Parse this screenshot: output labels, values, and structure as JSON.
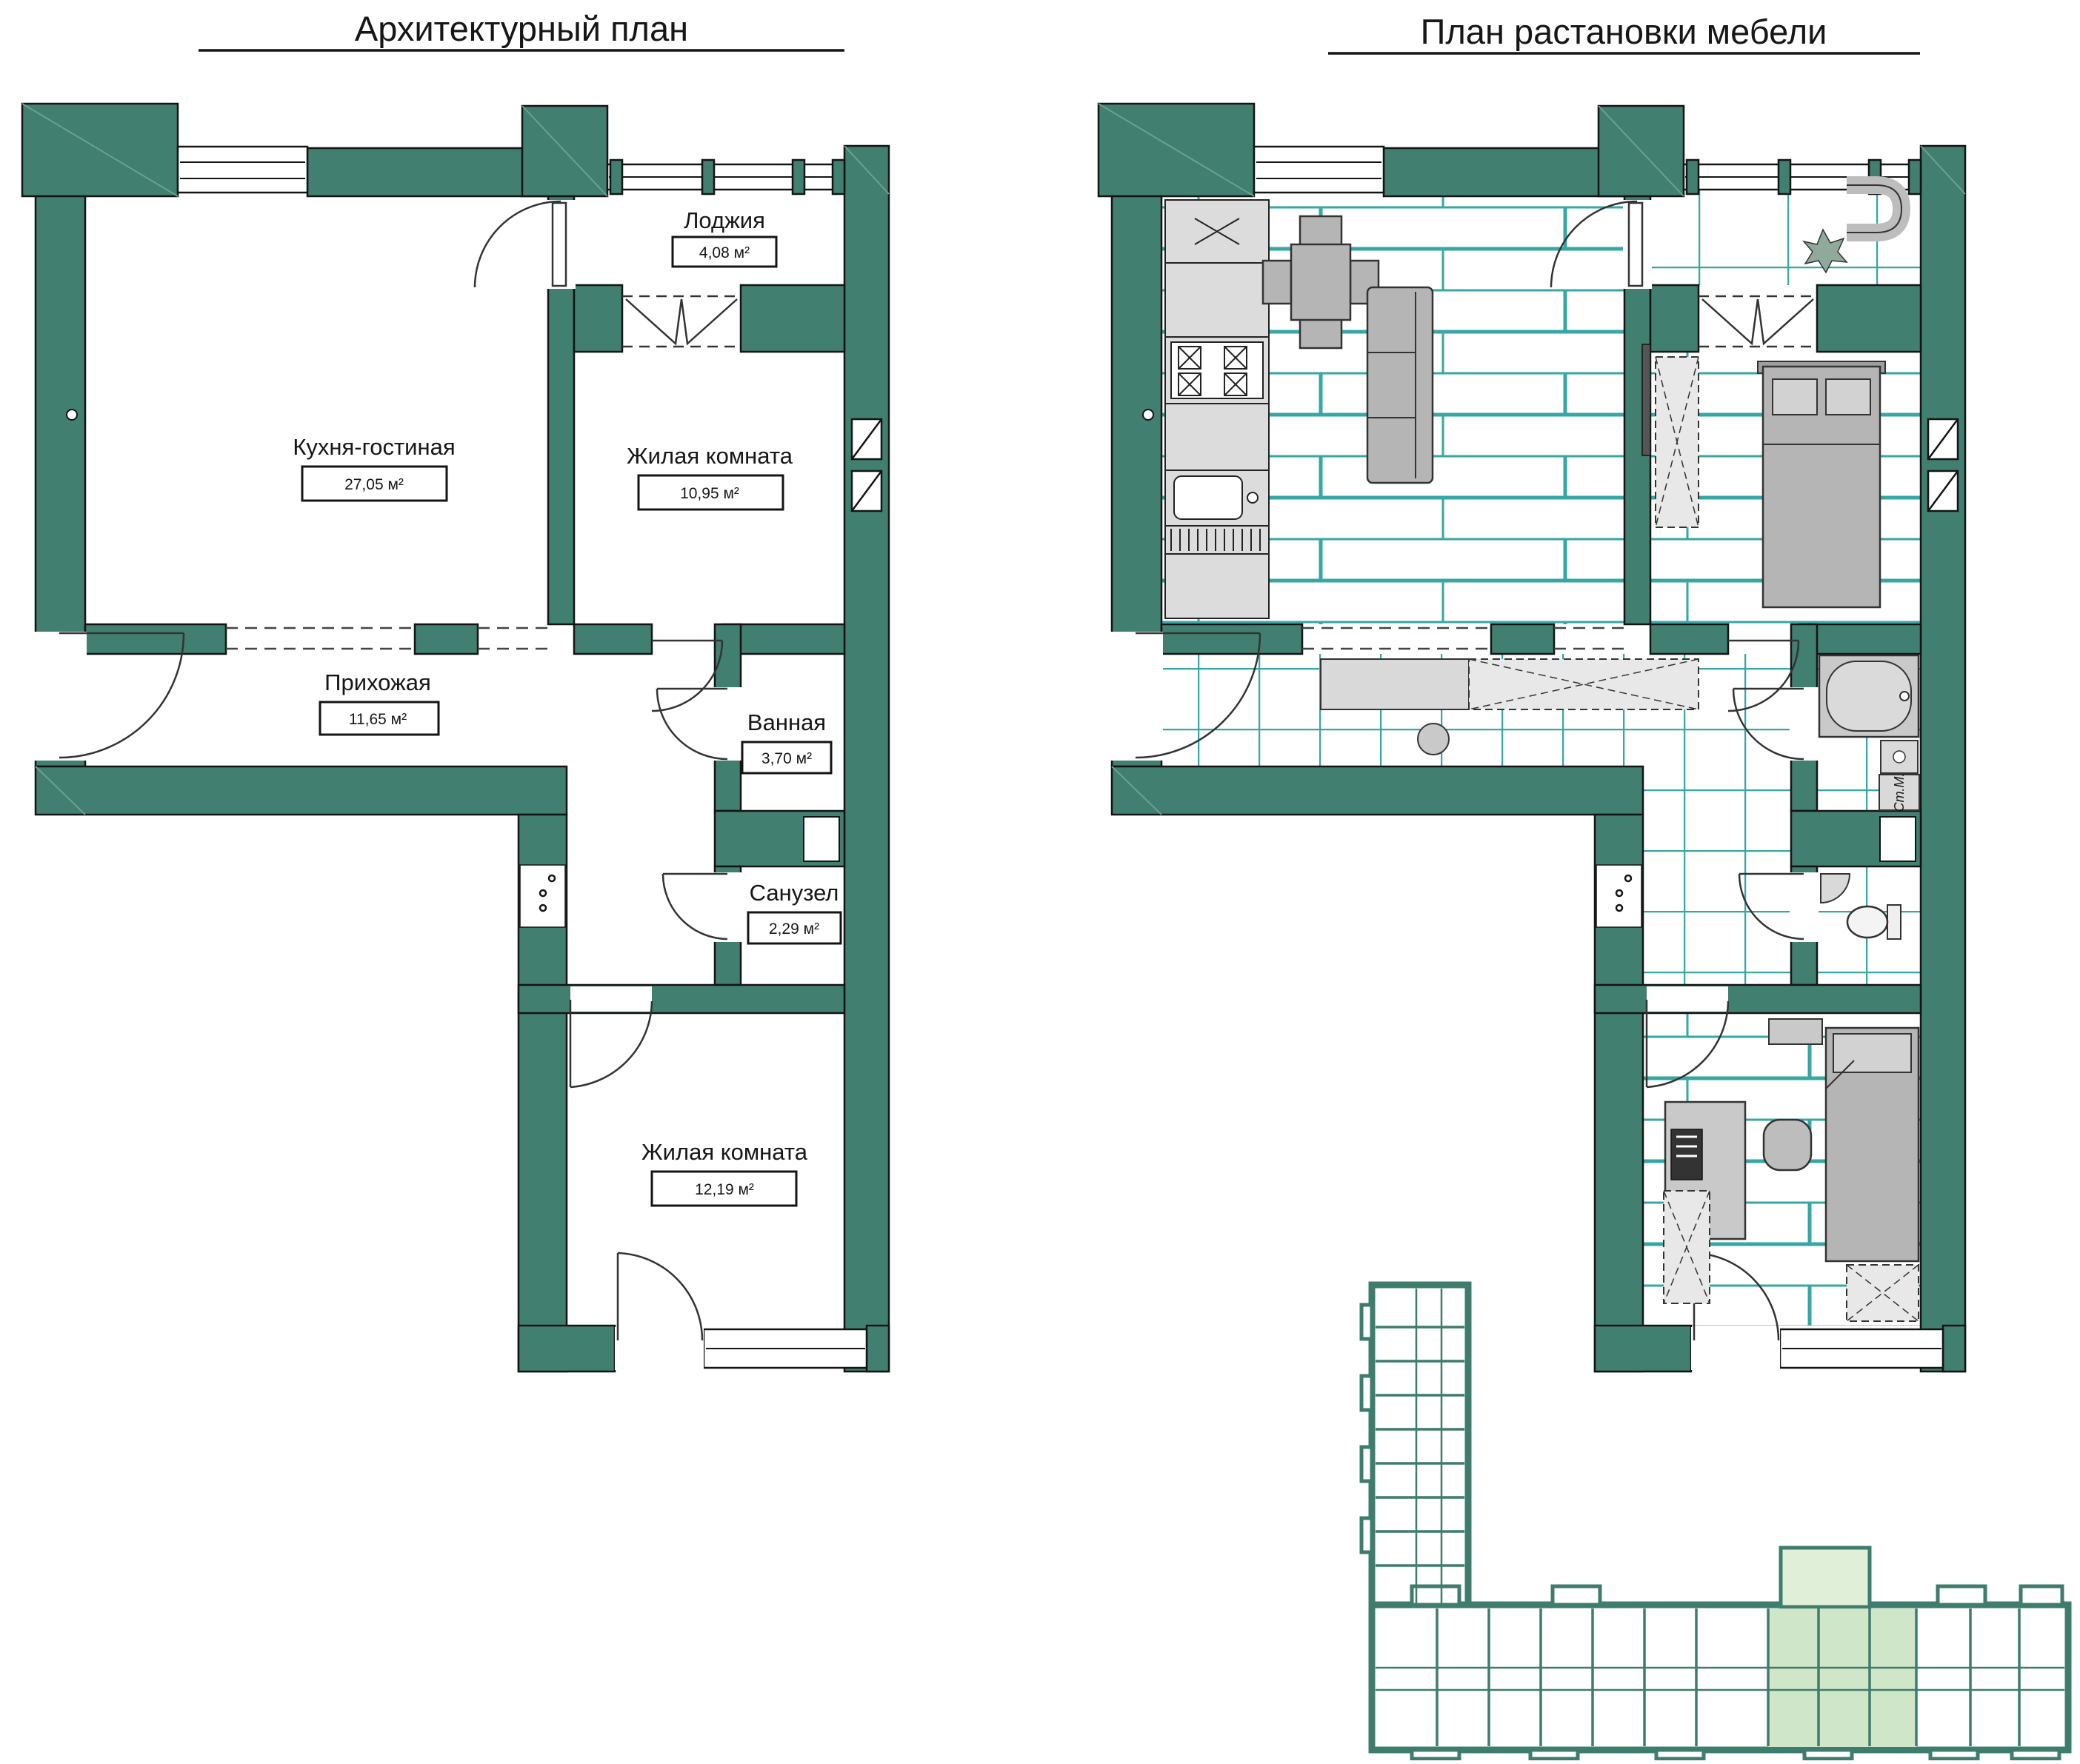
{
  "titles": {
    "left": "Архитектурный план",
    "right": "План растановки мебели"
  },
  "left_plan": {
    "rooms": [
      {
        "name": "Лоджия",
        "area": "4,08 м²"
      },
      {
        "name": "Кухня-гостиная",
        "area": "27,05 м²"
      },
      {
        "name": "Жилая комната",
        "area": "10,95 м²"
      },
      {
        "name": "Прихожая",
        "area": "11,65 м²"
      },
      {
        "name": "Ванная",
        "area": "3,70 м²"
      },
      {
        "name": "Санузел",
        "area": "2,29 м²"
      },
      {
        "name": "Жилая комната",
        "area": "12,19 м²"
      }
    ]
  },
  "right_plan": {
    "washing_machine_label": "Ст.М."
  },
  "colors": {
    "wall": "#417F70",
    "floor_line": "#36A7A5",
    "furniture_gray": "#B5B5B5",
    "counter_gray": "#DCDCDC",
    "highlight_unit": "#CFE7C8",
    "outline": "#141414"
  }
}
